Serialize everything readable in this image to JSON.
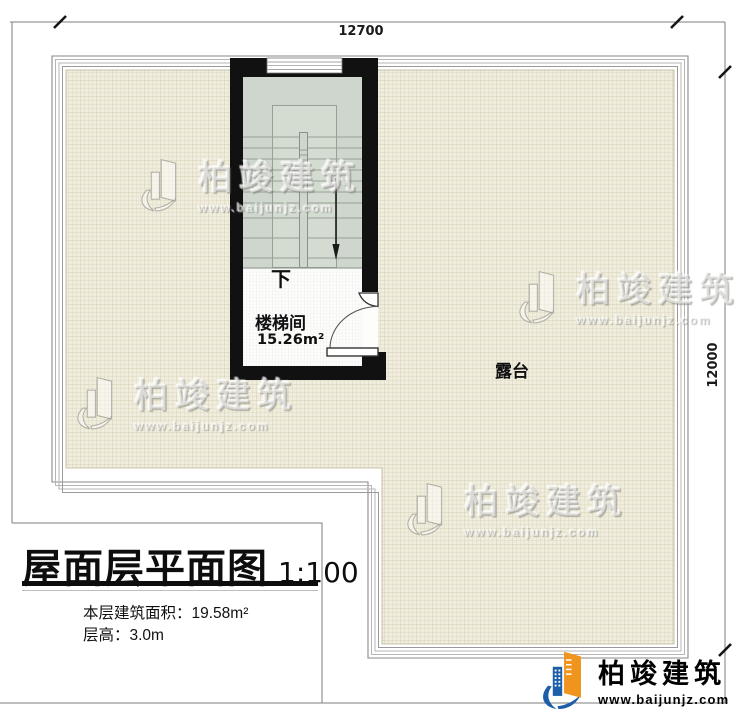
{
  "plan": {
    "dim_top": "12700",
    "dim_right": "12000",
    "stairwell": {
      "name": "楼梯间",
      "area": "15.26m²",
      "down_label": "下"
    },
    "terrace": {
      "name": "露台"
    }
  },
  "title_block": {
    "title": "屋面层平面图",
    "scale": "1:100",
    "floor_area": "本层建筑面积：19.58m²",
    "floor_height": "层高：3.0m"
  },
  "watermark": {
    "brand": "柏竣建筑",
    "url": "www.baijunjz.com"
  },
  "logo": {
    "brand": "柏竣建筑",
    "url": "www.baijunjz.com"
  },
  "colors": {
    "wall": "#111111",
    "roof_fill": "#f0edde",
    "roof_grid_line": "#d9d3b8",
    "stair_fill": "#ced6cd",
    "parapet_line": "#a8a8a8",
    "dimension_line": "#7d7d7d",
    "logo_orange": "#f0941d",
    "logo_blue": "#1c5fa8"
  }
}
